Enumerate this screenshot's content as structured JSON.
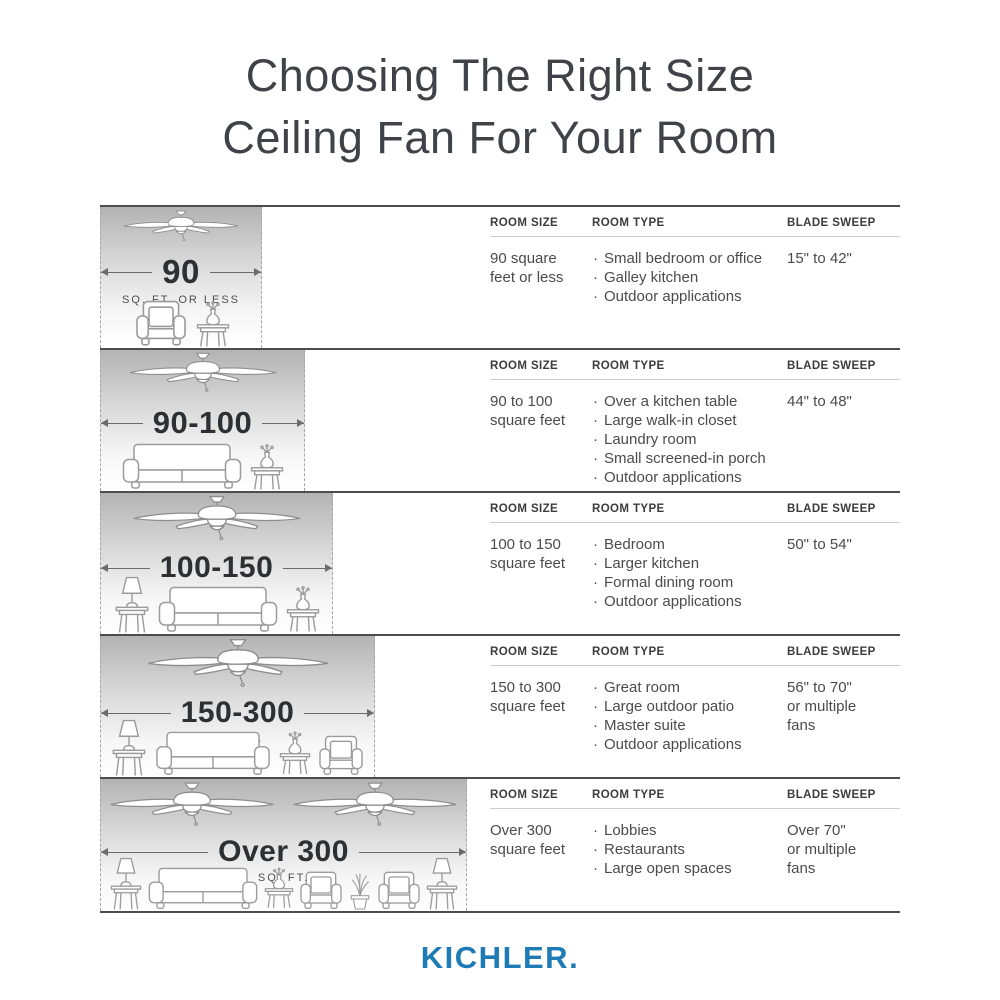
{
  "title": {
    "line1": "Choosing The Right Size",
    "line2": "Ceiling Fan For Your Room"
  },
  "columns": {
    "room_size": "ROOM SIZE",
    "room_type": "ROOM TYPE",
    "blade_sweep": "BLADE SWEEP"
  },
  "rows": [
    {
      "size_label": "90",
      "size_sublabel": "SQ. FT. OR LESS",
      "room_size": "90 square feet or less",
      "room_types": [
        "Small bedroom or office",
        "Galley kitchen",
        "Outdoor applications"
      ],
      "blade_sweep": "15\" to 42\""
    },
    {
      "size_label": "90-100",
      "size_sublabel": "SQ. FT.",
      "room_size": "90 to 100 square feet",
      "room_types": [
        "Over a kitchen table",
        "Large walk-in closet",
        "Laundry room",
        "Small screened-in porch",
        "Outdoor applications"
      ],
      "blade_sweep": "44\" to 48\""
    },
    {
      "size_label": "100-150",
      "size_sublabel": "SQ. FT.",
      "room_size": "100 to 150 square feet",
      "room_types": [
        "Bedroom",
        "Larger kitchen",
        "Formal dining room",
        "Outdoor applications"
      ],
      "blade_sweep": "50\" to 54\""
    },
    {
      "size_label": "150-300",
      "size_sublabel": "SQ. FT.",
      "room_size": "150 to 300 square feet",
      "room_types": [
        "Great room",
        "Large outdoor patio",
        "Master suite",
        "Outdoor applications"
      ],
      "blade_sweep": "56\" to 70\"\nor multiple\nfans"
    },
    {
      "size_label": "Over 300",
      "size_sublabel": "SQ. FT.",
      "room_size": "Over 300 square feet",
      "room_types": [
        "Lobbies",
        "Restaurants",
        "Large open spaces"
      ],
      "blade_sweep": "Over 70\"\nor multiple\nfans"
    }
  ],
  "brand": {
    "name": "KICHLER.",
    "color": "#1e7bb5"
  }
}
